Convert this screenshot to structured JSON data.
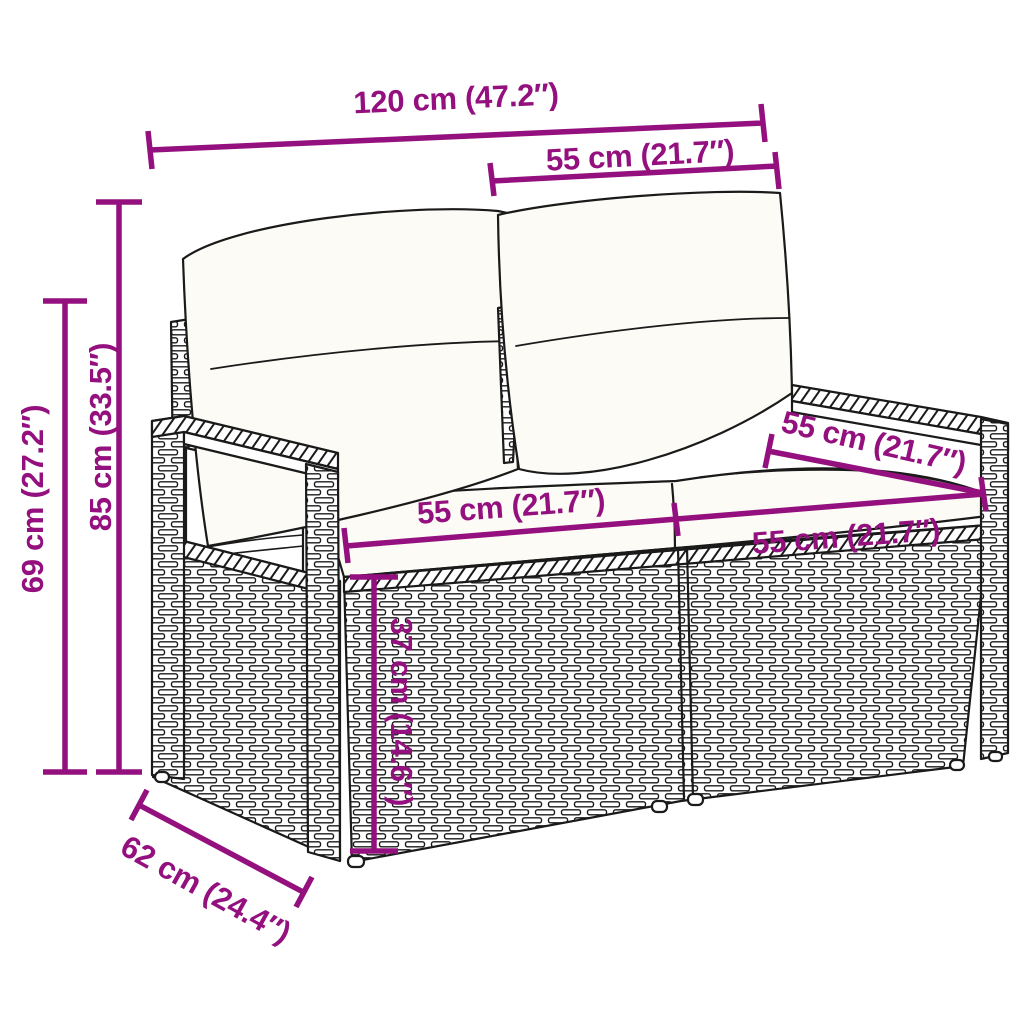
{
  "diagram": {
    "type": "product-dimension-diagram",
    "dimensions": {
      "overall_width": "120 cm (47.2″)",
      "backrest_width": "55 cm (21.7″)",
      "overall_height": "85 cm (33.5″)",
      "armrest_height": "69 cm (27.2″)",
      "seat_width_left": "55 cm (21.7″)",
      "seat_width_right": "55 cm (21.7″)",
      "seat_depth": "55 cm (21.7″)",
      "seat_height": "37 cm (14.6″)",
      "base_depth": "62 cm (24.4″)"
    },
    "colors": {
      "dimension_accent": "#94107E",
      "line_art": "#1a1a1a",
      "cushion_fill": "#fcfbf5",
      "background": "#ffffff"
    }
  }
}
